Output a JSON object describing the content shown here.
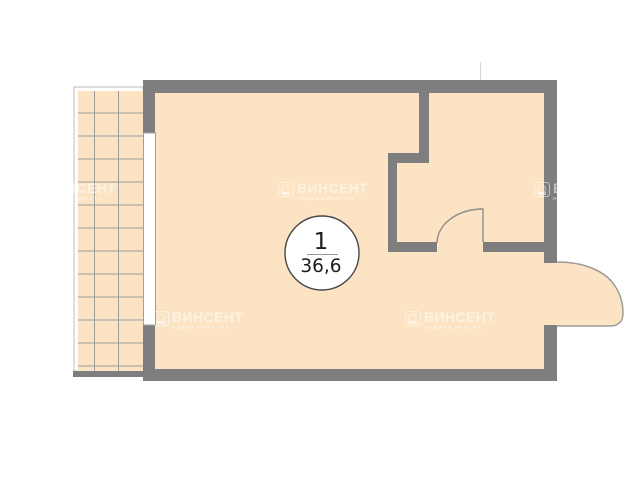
{
  "plan": {
    "unit": {
      "number": "1",
      "area": "36,6"
    },
    "colors": {
      "background": "#FFFFFF",
      "floor": "#FBE3C3",
      "wall": "#7E7E7E",
      "balcony_grid": "#9C9C9C",
      "door_line": "#8E8E8E",
      "label_circle_fill": "#FFFFFF",
      "label_circle_stroke": "#474747",
      "label_text": "#1C1C1C",
      "watermark": "#FFFFFF"
    }
  },
  "watermark": {
    "brand": "ВИНСЕНТ",
    "subtitle": "НЕДВИЖИМОСТЬ"
  }
}
